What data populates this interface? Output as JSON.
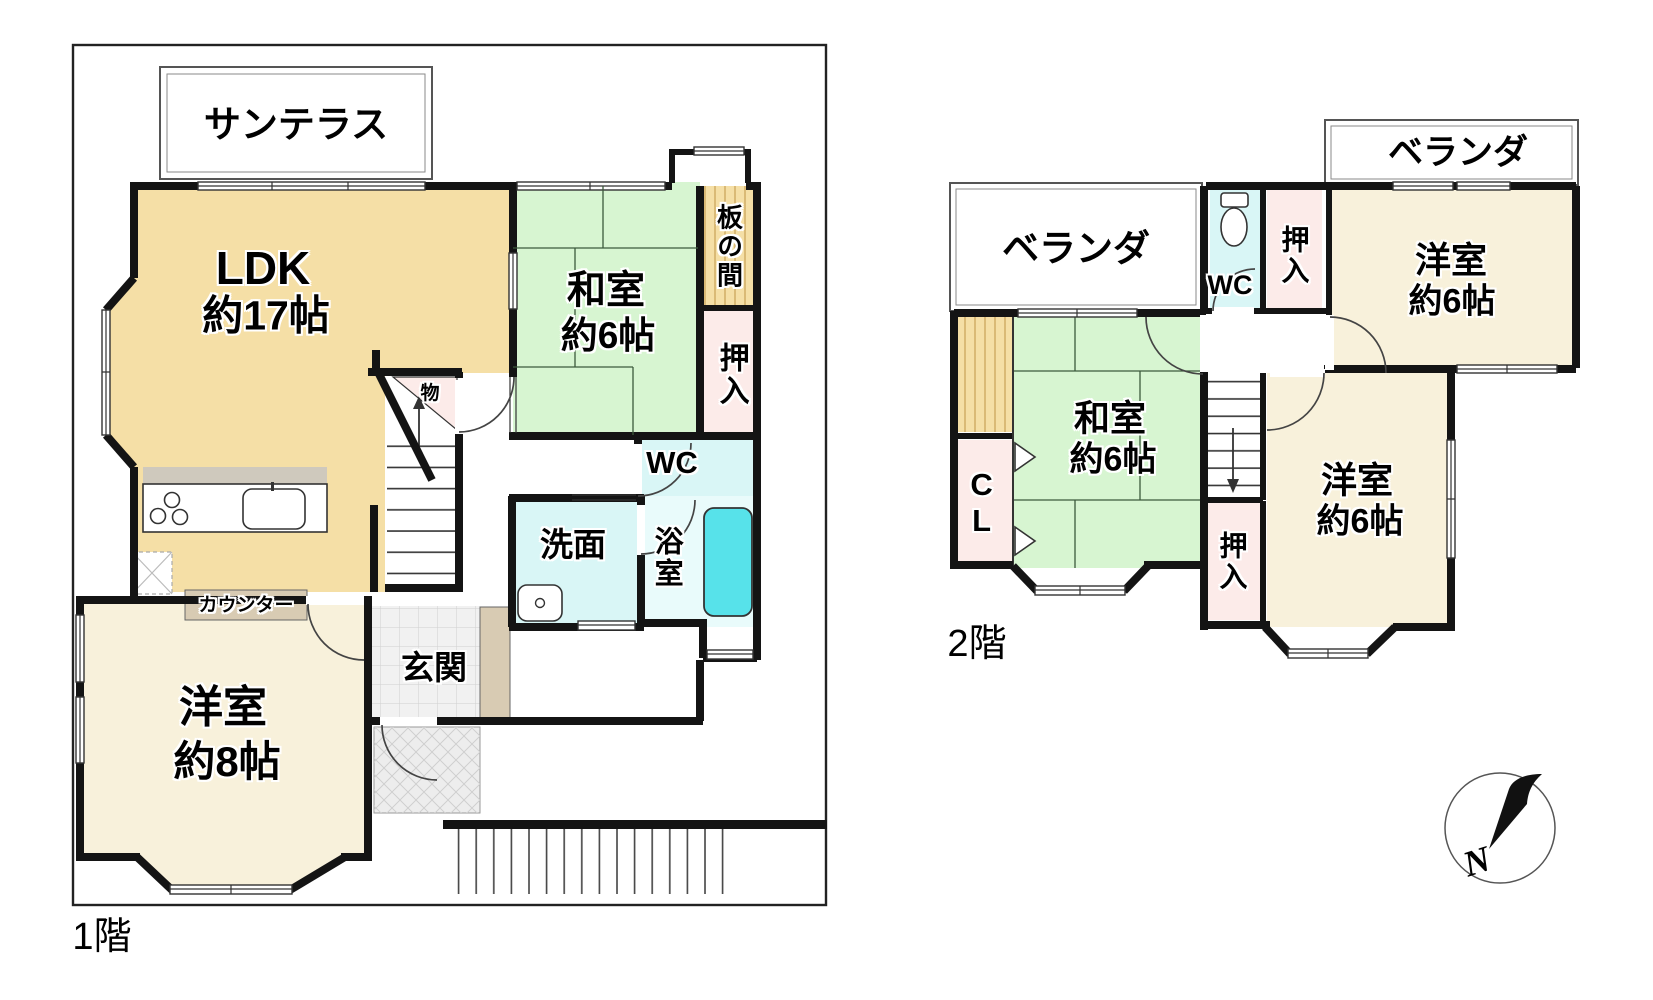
{
  "floor1": {
    "label": "1階",
    "sun_terrace": "サンテラス",
    "ldk": {
      "name": "LDK",
      "size": "約17帖"
    },
    "washitsu": {
      "name": "和室",
      "size": "約6帖"
    },
    "itanoma": "板の間",
    "oshiire": "押入",
    "wc": "WC",
    "senmen": "洗面",
    "yokushitsu": "浴室",
    "genkan": "玄関",
    "mono": "物",
    "counter": "カウンター",
    "youshitsu": {
      "name": "洋室",
      "size": "約8帖"
    }
  },
  "floor2": {
    "label": "2階",
    "veranda_left": "ベランダ",
    "veranda_right": "ベランダ",
    "wc": "WC",
    "oshiire_top": "押入",
    "oshiire_bottom": "押入",
    "closet": "CL",
    "washitsu": {
      "name": "和室",
      "size": "約6帖"
    },
    "youshitsu_ne": {
      "name": "洋室",
      "size": "約6帖"
    },
    "youshitsu_se": {
      "name": "洋室",
      "size": "約6帖"
    }
  },
  "compass": {
    "north": "N"
  },
  "colors": {
    "wall": "#141414",
    "tatami_green": "#d7f5d1",
    "wood_tan": "#f5dfa6",
    "closet_pink": "#fcebe9",
    "water_cyan": "#d9f6f6",
    "bath_floor": "#e9fbfb",
    "bathtub_cyan": "#57e2ea",
    "room_cream": "#f8f1db",
    "counter_beige": "#d8cbb3",
    "kitchen_gray": "#cfc9bd",
    "tile_gray": "#f1f1f1"
  }
}
